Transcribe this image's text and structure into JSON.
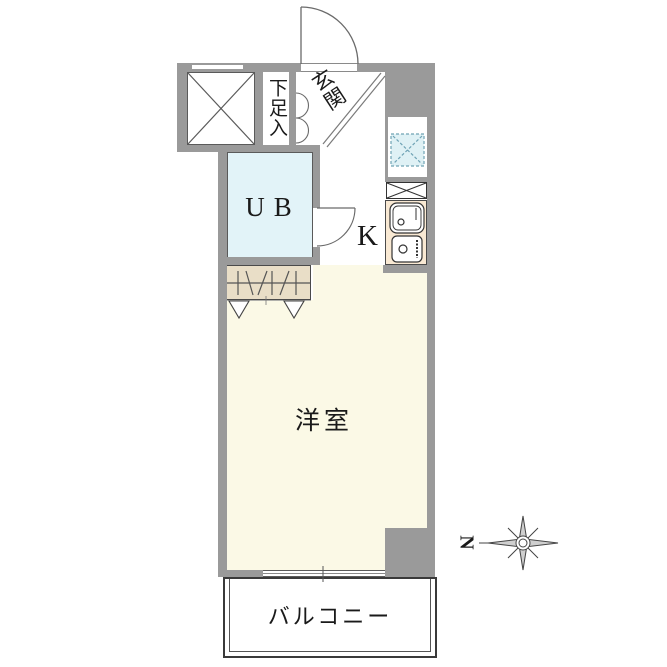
{
  "labels": {
    "entrance": "玄関",
    "shoe_storage": "下足入",
    "unit_bath": "UB",
    "kitchen": "K",
    "western_room": "洋室",
    "balcony": "バルコニー",
    "compass_north": "N"
  },
  "colors": {
    "wall": "#9a9a9a",
    "unit_bath_floor": "#e2f3f8",
    "closet_fill": "#e9dec7",
    "kitchen_counter_fill": "#f9e9d3",
    "washer_pan_fill": "#dff1f5",
    "room_floor": "#fbf9e6",
    "line": "#444444"
  }
}
